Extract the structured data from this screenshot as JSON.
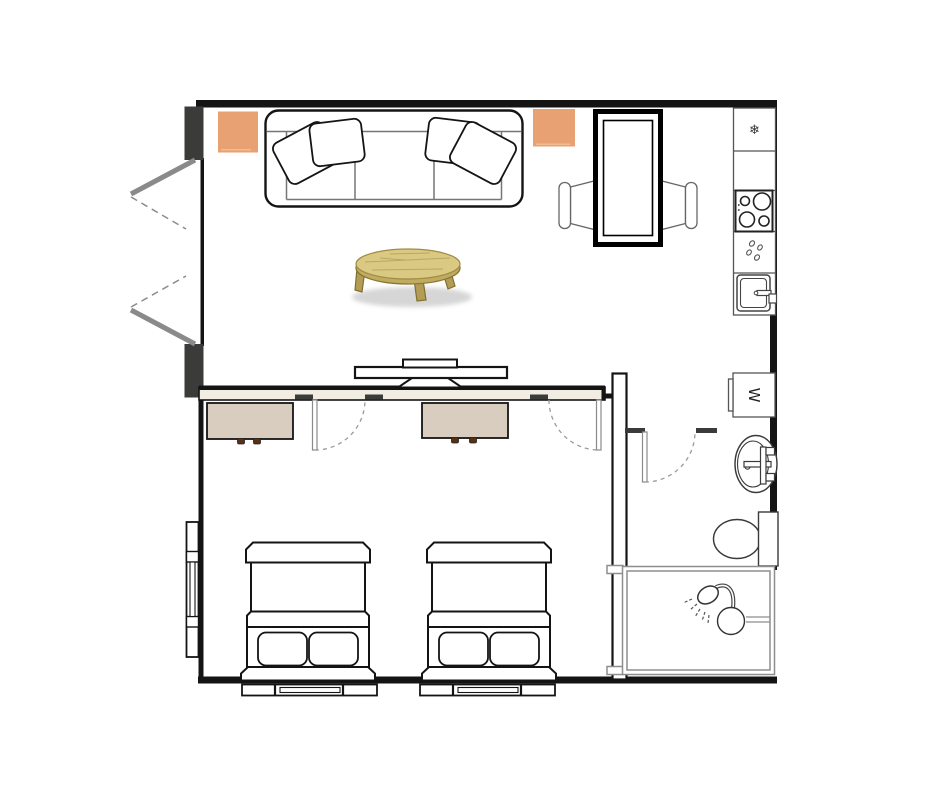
{
  "plan": {
    "canvas": {
      "width": 940,
      "height": 788
    },
    "glyphs": {
      "refrigerator": "❄",
      "washer": "W"
    },
    "colors": {
      "wall": "#141414",
      "door_jamb": "#3b3b39",
      "divider_fill": "#f1ede3",
      "accent_cushion": "#e8a172",
      "dresser": "#d9cdc0",
      "dresser_knob": "#5a3012",
      "door_swing": "#8a8a8a",
      "fixture_outline": "#3a3a3a",
      "shower_frame": "#8e8e8e",
      "wood_top": "#d9c983",
      "wood_rim": "#c1ab5e",
      "wood_leg": "#b29c56"
    },
    "rooms": {
      "living_room": {
        "furniture": [
          "sofa",
          "throw-pillows",
          "floor-cushion-left",
          "floor-cushion-right",
          "coffee-table",
          "dining-table",
          "dining-chair-left",
          "dining-chair-right",
          "tv-console"
        ]
      },
      "kitchen": {
        "appliances": [
          "refrigerator",
          "counter",
          "cooktop",
          "prep-counter",
          "sink"
        ]
      },
      "bedroom": {
        "furniture": [
          "dresser-1",
          "dresser-2",
          "bed-1",
          "bed-2"
        ]
      },
      "bathroom": {
        "fixtures": [
          "washing-machine",
          "sink",
          "toilet",
          "shower"
        ]
      }
    },
    "openings": [
      "entry-double-door",
      "bedroom-door-1",
      "bedroom-door-2",
      "bathroom-door",
      "window-left-wall",
      "window-bed-1",
      "window-bed-2"
    ]
  }
}
